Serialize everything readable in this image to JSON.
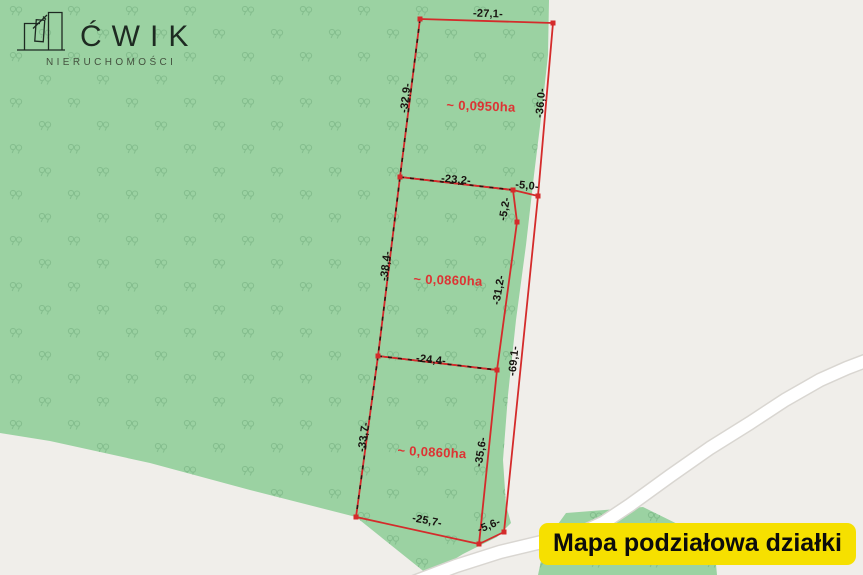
{
  "brand": {
    "name": "ĆWIK",
    "subtitle": "NIERUCHOMOŚCI"
  },
  "banner": {
    "text": "Mapa podziałowa działki"
  },
  "map": {
    "type": "cadastral-division-map",
    "vegetation_symbol": "deciduous-tree-pair",
    "plots": {
      "plot1": {
        "area": "~ 0,0950ha"
      },
      "plot2": {
        "area": "~ 0,0860ha"
      },
      "plot3": {
        "area": "~ 0,0860ha"
      }
    },
    "dimensions": {
      "plot1_top": "-27,1-",
      "plot1_left": "-32,9-",
      "plot1_right": "-36,0-",
      "plot2_top": "-23,2-",
      "connector_top": "-5,0-",
      "plot2_right_upper": "-5,2-",
      "plot2_left": "-38,4-",
      "plot2_right_lower": "-31,2-",
      "outer_right": "-69,1-",
      "plot3_top": "-24,4-",
      "plot3_left": "-33,7-",
      "plot3_right": "-35,6-",
      "plot3_bottom": "-25,7-",
      "connector_bottom": "-5,6-"
    },
    "colors": {
      "forest_green": "#9bd2a2",
      "tree_symbol_green": "#7fb98a",
      "boundary_red": "#d42b2b",
      "area_label_red": "#dd3333",
      "background_gray": "#f0eeea",
      "road_white": "#ffffff",
      "banner_yellow": "#f6e000"
    }
  }
}
